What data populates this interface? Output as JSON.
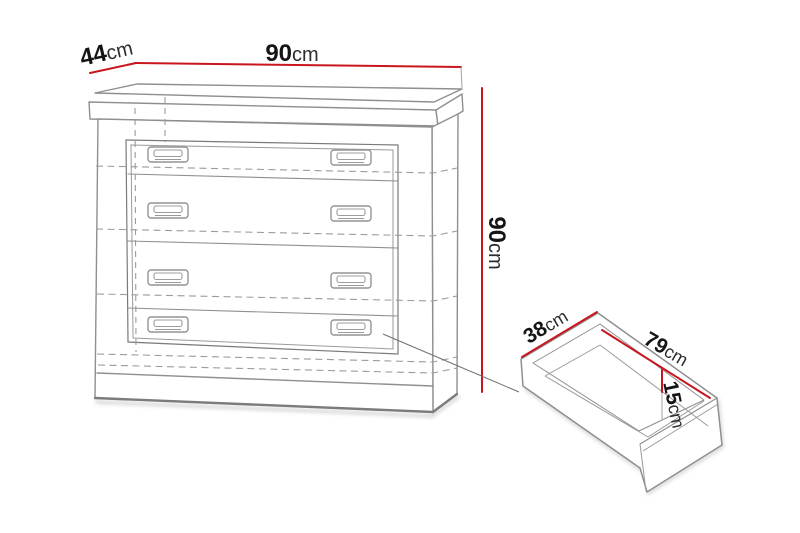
{
  "diagram": {
    "subject": "chest-of-drawers dimension diagram with pull-out drawer detail",
    "cabinet_dimensions": {
      "width": {
        "num": "90",
        "unit": "cm"
      },
      "depth": {
        "num": "44",
        "unit": "cm"
      },
      "height": {
        "num": "90",
        "unit": "cm"
      }
    },
    "drawer_dimensions": {
      "depth": {
        "num": "38",
        "unit": "cm"
      },
      "width": {
        "num": "79",
        "unit": "cm"
      },
      "height": {
        "num": "15",
        "unit": "cm"
      }
    },
    "colors": {
      "dimension_line": "#c9161e",
      "outline": "#8f8f8f",
      "label": "#151515",
      "background": "#ffffff"
    }
  }
}
